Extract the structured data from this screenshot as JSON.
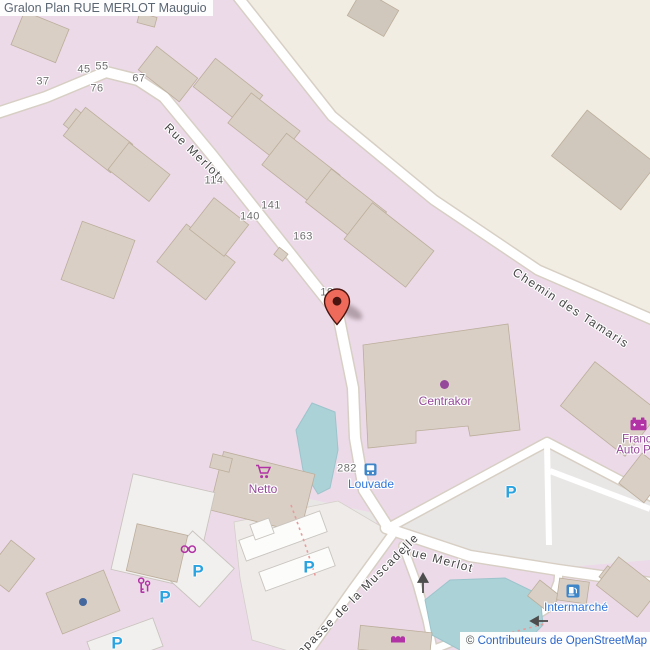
{
  "header": {
    "title": "Gralon Plan RUE MERLOT Mauguio"
  },
  "attribution": {
    "symbol": "©",
    "text": "Contributeurs de OpenStreetMap"
  },
  "streets": {
    "merlot_upper": "Rue Merlot",
    "merlot_lower": "Rue Merlot",
    "tamaris": "Chemin des Tamaris",
    "muscadelle": "Impasse de la Muscadelle"
  },
  "house_numbers": {
    "n37": "37",
    "n45": "45",
    "n55": "55",
    "n67": "67",
    "n76": "76",
    "n114": "114",
    "n140": "140",
    "n141": "141",
    "n163": "163",
    "n282": "282",
    "n19": "19"
  },
  "pois": {
    "centrakor": "Centrakor",
    "netto": "Netto",
    "louvade": "Louvade",
    "intermarche": "Intermarché",
    "france_auto_line1": "France",
    "france_auto_line2": "Auto Piè"
  },
  "parking": {
    "symbol": "P"
  },
  "icons": {
    "marker": "map-marker-pin",
    "bus": "bus-stop",
    "fuel": "fuel-station",
    "battery": "car-battery",
    "cart": "shopping-cart",
    "glasses": "optician-glasses",
    "keys": "keys",
    "awning": "shop-awning",
    "poi_dot": "poi-dot",
    "blue_dot": "poi-blue-dot"
  },
  "colors": {
    "residential": "#ecdae9",
    "land": "#f1ede3",
    "building": "#d9cfc5",
    "building_stroke": "#bcae9b",
    "building_gray": "#d0c8bd",
    "road_casing": "#d7cfc4",
    "parking_area": "#e9e7e6",
    "white_building": "#f2f0ef",
    "white_building_stroke": "#c9c4be",
    "water": "#abd2d7",
    "water_stroke": "#9cc4cb",
    "poi_purple": "#95489a",
    "icon_purple": "#b233a5",
    "poi_blue": "#2f75db",
    "parking_blue": "#2ba3e0",
    "transit_blue": "#3e86c8",
    "number_gray": "#6f6f6f",
    "street_gray": "#454545",
    "marker_red": "#ee6a5a",
    "marker_dark": "#4a1410",
    "dashed_red": "#ea9a9a",
    "arrow_gray": "#4d4d4d",
    "header_text": "#5a6672",
    "copyright_blue": "#2a66c8",
    "dot_blue": "#44689e"
  }
}
